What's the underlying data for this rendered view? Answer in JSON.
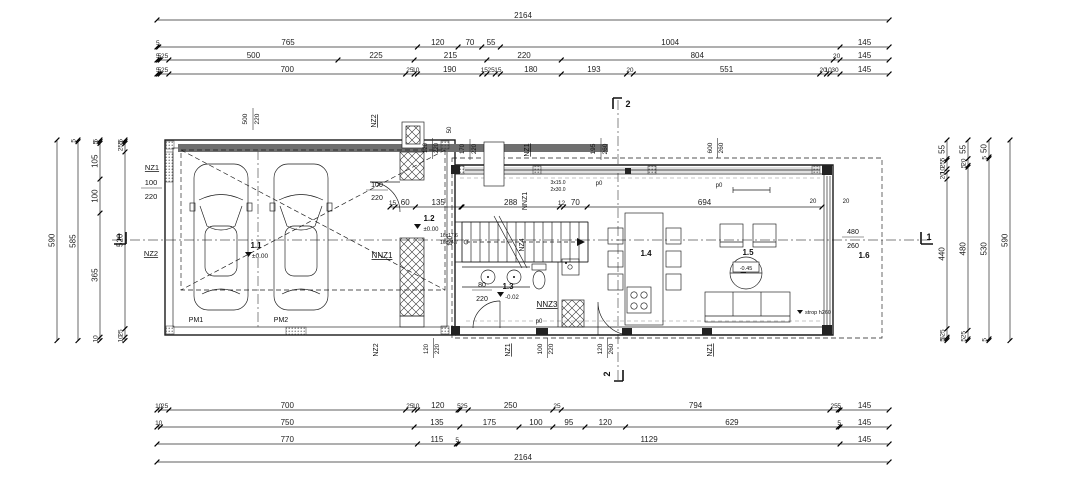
{
  "drawing": {
    "type": "floor-plan"
  },
  "dim_rows": {
    "top": [
      [
        2164
      ],
      [
        5,
        765,
        120,
        70,
        55,
        1004,
        145
      ],
      [
        5,
        5,
        25,
        500,
        225,
        215,
        220,
        804,
        20,
        145
      ],
      [
        5,
        5,
        25,
        700,
        25,
        10,
        190,
        15,
        25,
        15,
        180,
        193,
        20,
        551,
        20,
        10,
        30,
        145
      ]
    ],
    "bottom": [
      [
        10,
        25,
        700,
        25,
        10,
        120,
        5,
        25,
        250,
        25,
        794,
        25,
        5,
        145
      ],
      [
        10,
        750,
        135,
        175,
        100,
        95,
        120,
        629,
        5,
        145
      ],
      [
        770,
        115,
        5,
        1129,
        145
      ],
      [
        2164
      ]
    ],
    "left": [
      [
        590
      ],
      [
        5,
        585
      ],
      [
        5,
        5,
        105,
        100,
        365,
        10
      ],
      [
        5,
        5,
        25,
        520,
        25,
        10
      ]
    ],
    "right": [
      [
        55,
        5,
        25,
        10,
        20,
        440,
        25,
        5,
        5
      ],
      [
        55,
        20,
        5,
        480,
        25,
        5
      ],
      [
        50,
        5,
        530,
        5
      ],
      [
        590
      ]
    ]
  },
  "interior_dims": {
    "hall": [
      15,
      60,
      135
    ],
    "main": [
      288,
      12,
      70,
      694
    ]
  },
  "rooms": {
    "garage": {
      "number": "1.1",
      "level": "±0.00"
    },
    "entry": {
      "number": "1.2",
      "level": "±0.00"
    },
    "bath": {
      "number": "1.3",
      "level": "-0.02"
    },
    "kitchen_dining": {
      "number": "1.4"
    },
    "living": {
      "number": "1.5",
      "level": "-0.45"
    },
    "terrace": {
      "number": "1.6"
    }
  },
  "parking": {
    "pm1": "PM1",
    "pm2": "PM2"
  },
  "wall_labels": {
    "nz1_left": "NZ1",
    "nz2_left": "NZ2",
    "nz2_top": "NZ2",
    "nz1_top": "NZ1",
    "nnz1_garage": "NNZ1",
    "nnz1_stair": "NNZ1",
    "nz4_stair": "NZ4",
    "nnz3": "NNZ3",
    "nz2_bottom": "NZ2",
    "nz1_bottom_a": "NZ1",
    "nz1_bottom_b": "NZ1"
  },
  "openings": {
    "nz1_left_size": {
      "w": 100,
      "h": 220
    },
    "garage_window": {
      "w": 500,
      "h": 220
    },
    "entry_door": {
      "w": 100,
      "h": 220
    },
    "bath_door": {
      "w": 80,
      "h": 220
    },
    "win_top_120": {
      "w": 120,
      "h": 220
    },
    "win_top_170": {
      "w": 170,
      "h": 220
    },
    "win_195": {
      "w": 195,
      "h": 260
    },
    "win_600": {
      "w": 600,
      "h": 260
    },
    "win_480": {
      "w": 480,
      "h": 260
    },
    "win_bottom_120_220": {
      "w": 120,
      "h": 220
    },
    "win_bottom_100": {
      "w": 100,
      "h": 220
    },
    "win_bottom_120_260": {
      "w": 120,
      "h": 260
    }
  },
  "stair": {
    "run_a": "16x17.6",
    "run_b": "16x24.7",
    "note_a": "3x15.0",
    "note_b": "2x30.0"
  },
  "notes": {
    "p0": "p0",
    "strop": "strop h260",
    "d50": "50"
  },
  "small_dims": {
    "d20a": 20,
    "d20b": 20,
    "d100": 100
  },
  "section_marks": {
    "one": "1",
    "two": "2"
  }
}
